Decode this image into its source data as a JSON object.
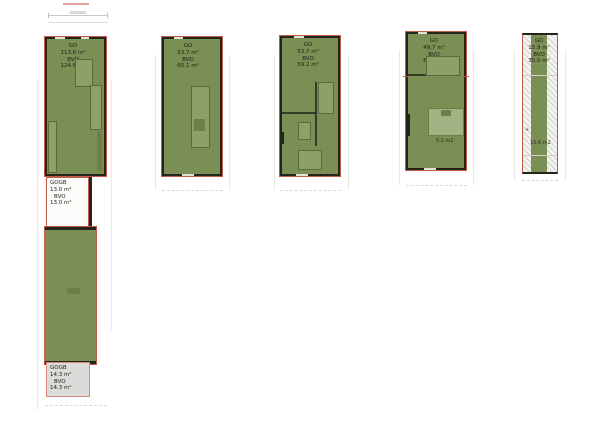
{
  "colors": {
    "plan_green": "#7b8f55",
    "wall_dark": "#23251b",
    "outline_red": "#c05a4b",
    "furniture_fill": "#8da066",
    "gogb_white": "#fcfcfb",
    "gogb_gray": "#dbdbd9",
    "text_dark": "#1c2016"
  },
  "plans": [
    {
      "name": "unit-1",
      "go": {
        "title": "GO",
        "area": "113.6 m²",
        "bvo": "BVO",
        "bvo_area": "124.8 m²"
      },
      "gogb_top": {
        "title": "GOGB",
        "area": "13.0 m²",
        "bvo": "BVO",
        "bvo_area": "13.0 m²"
      },
      "gogb_bottom": {
        "title": "GOGB",
        "area": "14.3 m²",
        "bvo": "BVO",
        "bvo_area": "14.3 m²"
      }
    },
    {
      "name": "unit-2",
      "go": {
        "title": "GO",
        "area": "53.7 m²",
        "bvo": "BVO",
        "bvo_area": "60.1 m²"
      }
    },
    {
      "name": "unit-3",
      "go": {
        "title": "GO",
        "area": "53.7 m²",
        "bvo": "BVO",
        "bvo_area": "59.2 m²"
      }
    },
    {
      "name": "unit-4",
      "go": {
        "title": "GO",
        "area": "49.7 m²",
        "bvo": "BVO",
        "bvo_area": "63.3 m²"
      },
      "annotation": "5.2 m2"
    },
    {
      "name": "unit-5",
      "go": {
        "title": "GO",
        "area": "15.9 m²",
        "bvo": "BVO",
        "bvo_area": "35.0 m²"
      },
      "annotation": "15.6 m2",
      "corner_mark": "+"
    }
  ]
}
